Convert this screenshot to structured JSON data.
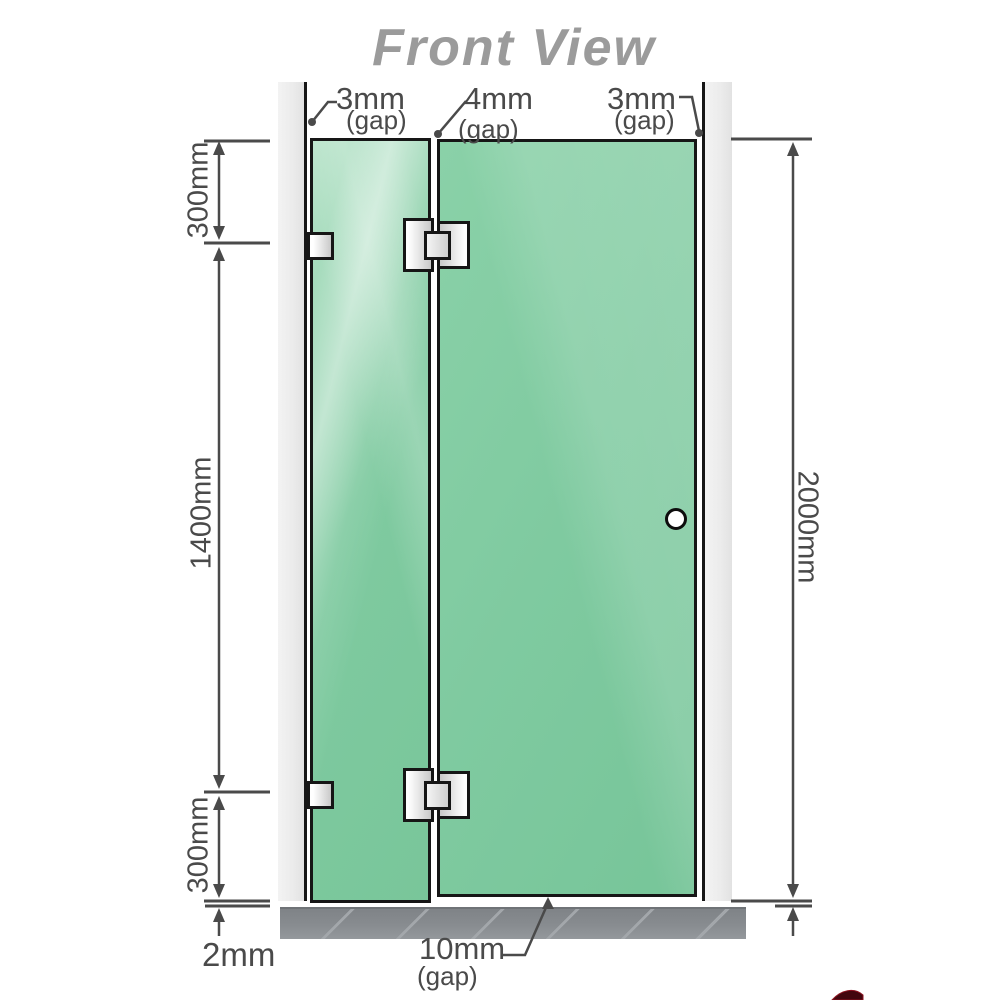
{
  "title": "Front View",
  "dimension_labels": {
    "top_section": "300mm",
    "middle_section": "1400mm",
    "bottom_section": "300mm",
    "total_height": "2000mm",
    "floor_clearance": "2mm"
  },
  "gap_labels": {
    "left": {
      "value": "3mm",
      "caption": "(gap)"
    },
    "middle": {
      "value": "4mm",
      "caption": "(gap)"
    },
    "right": {
      "value": "3mm",
      "caption": "(gap)"
    },
    "bottom": {
      "value": "10mm",
      "caption": "(gap)"
    }
  },
  "colors": {
    "glass_green": "#7fcaa0",
    "glass_green_light": "#b7e3c9",
    "frame_black": "#161616",
    "wall_channel_gray": "#ebebeb",
    "floor_gray": "#888c90",
    "floor_hatch": "#a3a7ab",
    "dimension_gray": "#4a4a4a",
    "title_gray": "#9b9b9b",
    "hardware_silver": "#c9c9c9"
  }
}
